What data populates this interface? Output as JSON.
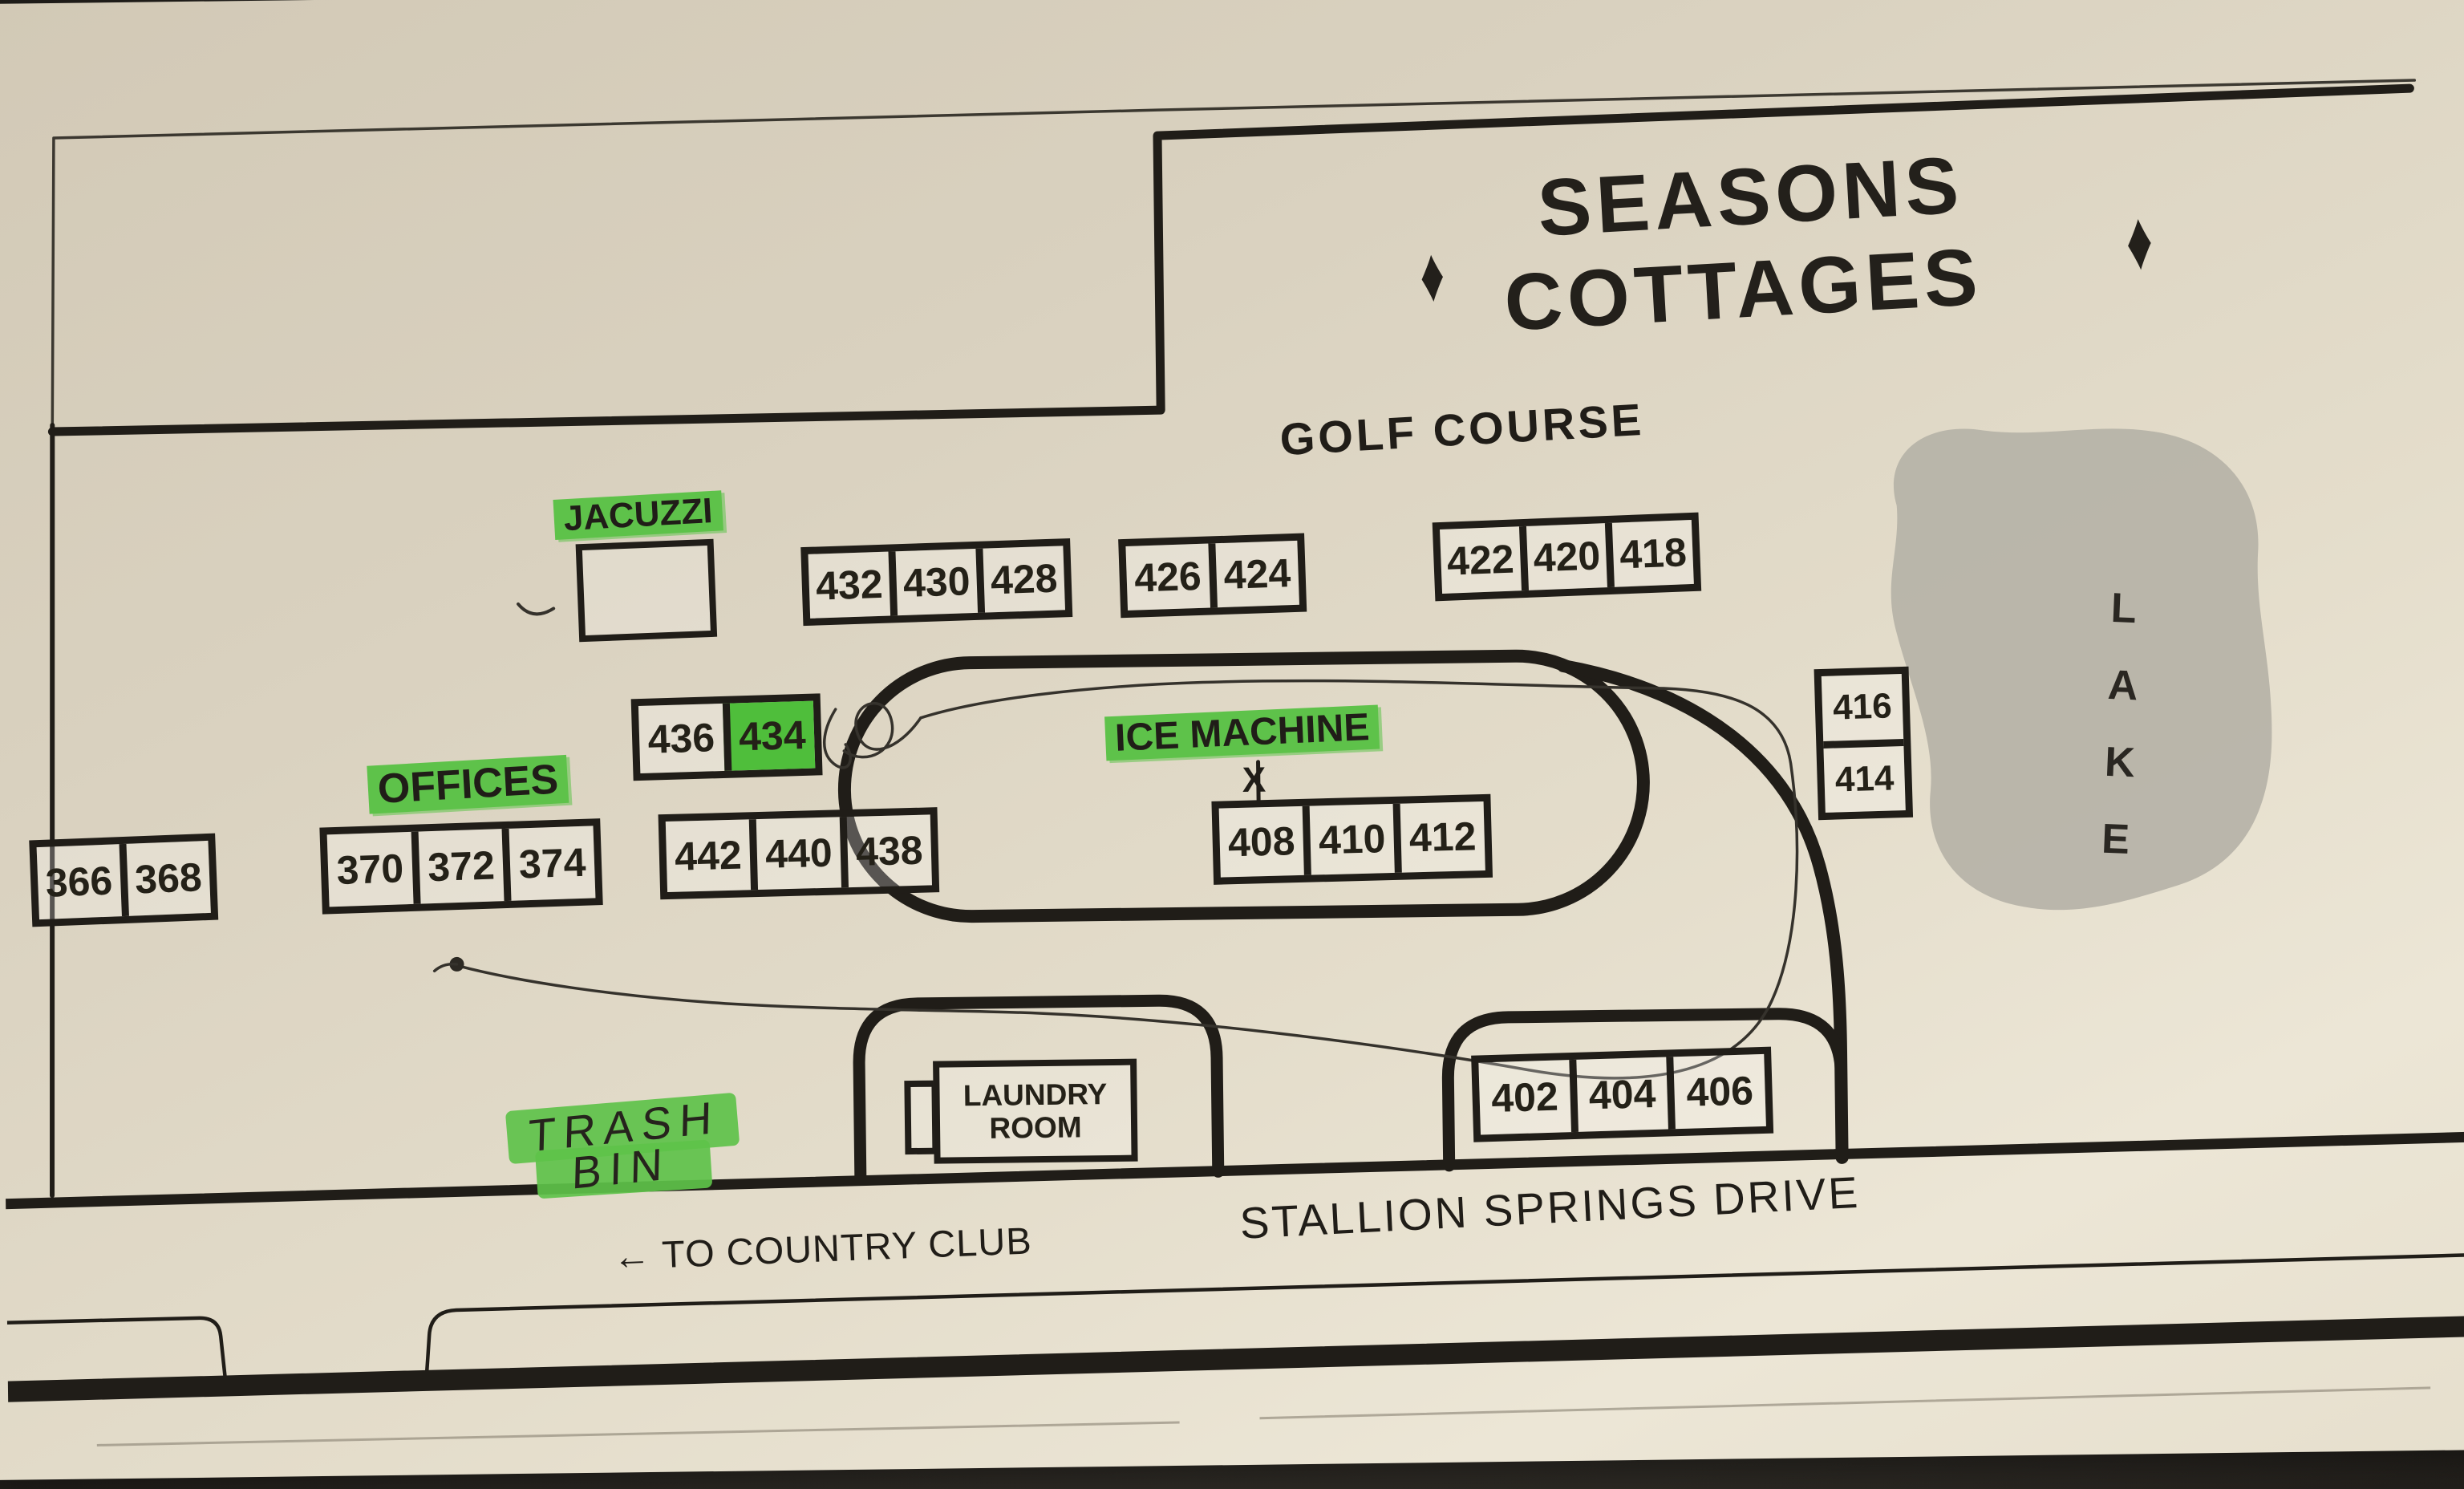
{
  "title": {
    "line1": "SEASONS",
    "line2": "COTTAGES",
    "diamond": "♦"
  },
  "areas": {
    "golf_course": "GOLF COURSE",
    "lake_letters": [
      "L",
      "A",
      "K",
      "E"
    ]
  },
  "labels": {
    "jacuzzi": "JACUZZI",
    "ice_machine": "ICE MACHINE",
    "offices": "OFFICES",
    "laundry_line1": "LAUNDRY",
    "laundry_line2": "ROOM",
    "trash_line1": "TRASH",
    "trash_line2": "BIN",
    "to_country_club": "← TO COUNTRY CLUB",
    "street": "STALLION SPRINGS DRIVE",
    "x_marker": "X"
  },
  "unit_groups": [
    {
      "id": "group-432-430-428",
      "units": [
        "432",
        "430",
        "428"
      ]
    },
    {
      "id": "group-426-424",
      "units": [
        "426",
        "424"
      ]
    },
    {
      "id": "group-422-420-418",
      "units": [
        "422",
        "420",
        "418"
      ]
    },
    {
      "id": "group-436-434",
      "units": [
        "436",
        "434"
      ],
      "highlighted_unit": "434"
    },
    {
      "id": "group-366-368",
      "units": [
        "366",
        "368"
      ]
    },
    {
      "id": "group-370-372-374",
      "units": [
        "370",
        "372",
        "374"
      ]
    },
    {
      "id": "group-442-440-438",
      "units": [
        "442",
        "440",
        "438"
      ]
    },
    {
      "id": "group-408-410-412",
      "units": [
        "408",
        "410",
        "412"
      ]
    },
    {
      "id": "group-416-414",
      "units": [
        "416",
        "414"
      ]
    },
    {
      "id": "group-402-404-406",
      "units": [
        "402",
        "404",
        "406"
      ]
    }
  ],
  "colors": {
    "highlight_green": "#5ec24a",
    "unit_green": "#4fbe3b",
    "ink": "#201d18",
    "lake_gray": "#b5b1a6"
  }
}
